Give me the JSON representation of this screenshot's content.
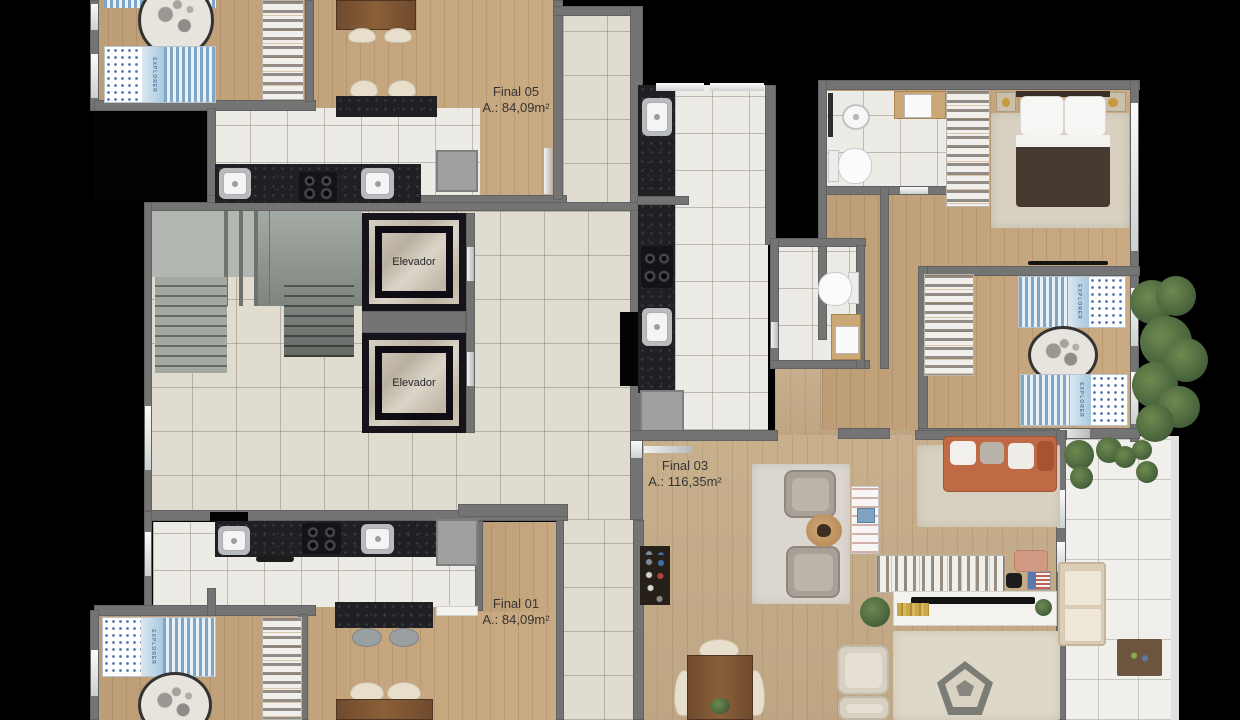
{
  "units": [
    {
      "id": "final-05",
      "label": "Final 05",
      "area_label": "A.: 84,09m²"
    },
    {
      "id": "final-03",
      "label": "Final 03",
      "area_label": "A.: 116,35m²"
    },
    {
      "id": "final-01",
      "label": "Final 01",
      "area_label": "A.: 84,09m²"
    }
  ],
  "elevators": [
    "Elevador",
    "Elevador"
  ],
  "bed_brand": "EXPLORER",
  "colors": {
    "background": "#000000",
    "wall": "#747474",
    "wood_floor": "#c7a67c",
    "kitchen_tile": "#edebe6",
    "lobby_tile": "#e1dcd0",
    "counter": "#202024",
    "elevator_marble": "#cbc4b8",
    "sofa_accent": "#bf6a45",
    "kid_bed_blue": "#7fa6c6",
    "plant_green": "#46613a",
    "label_text": "#353535"
  }
}
